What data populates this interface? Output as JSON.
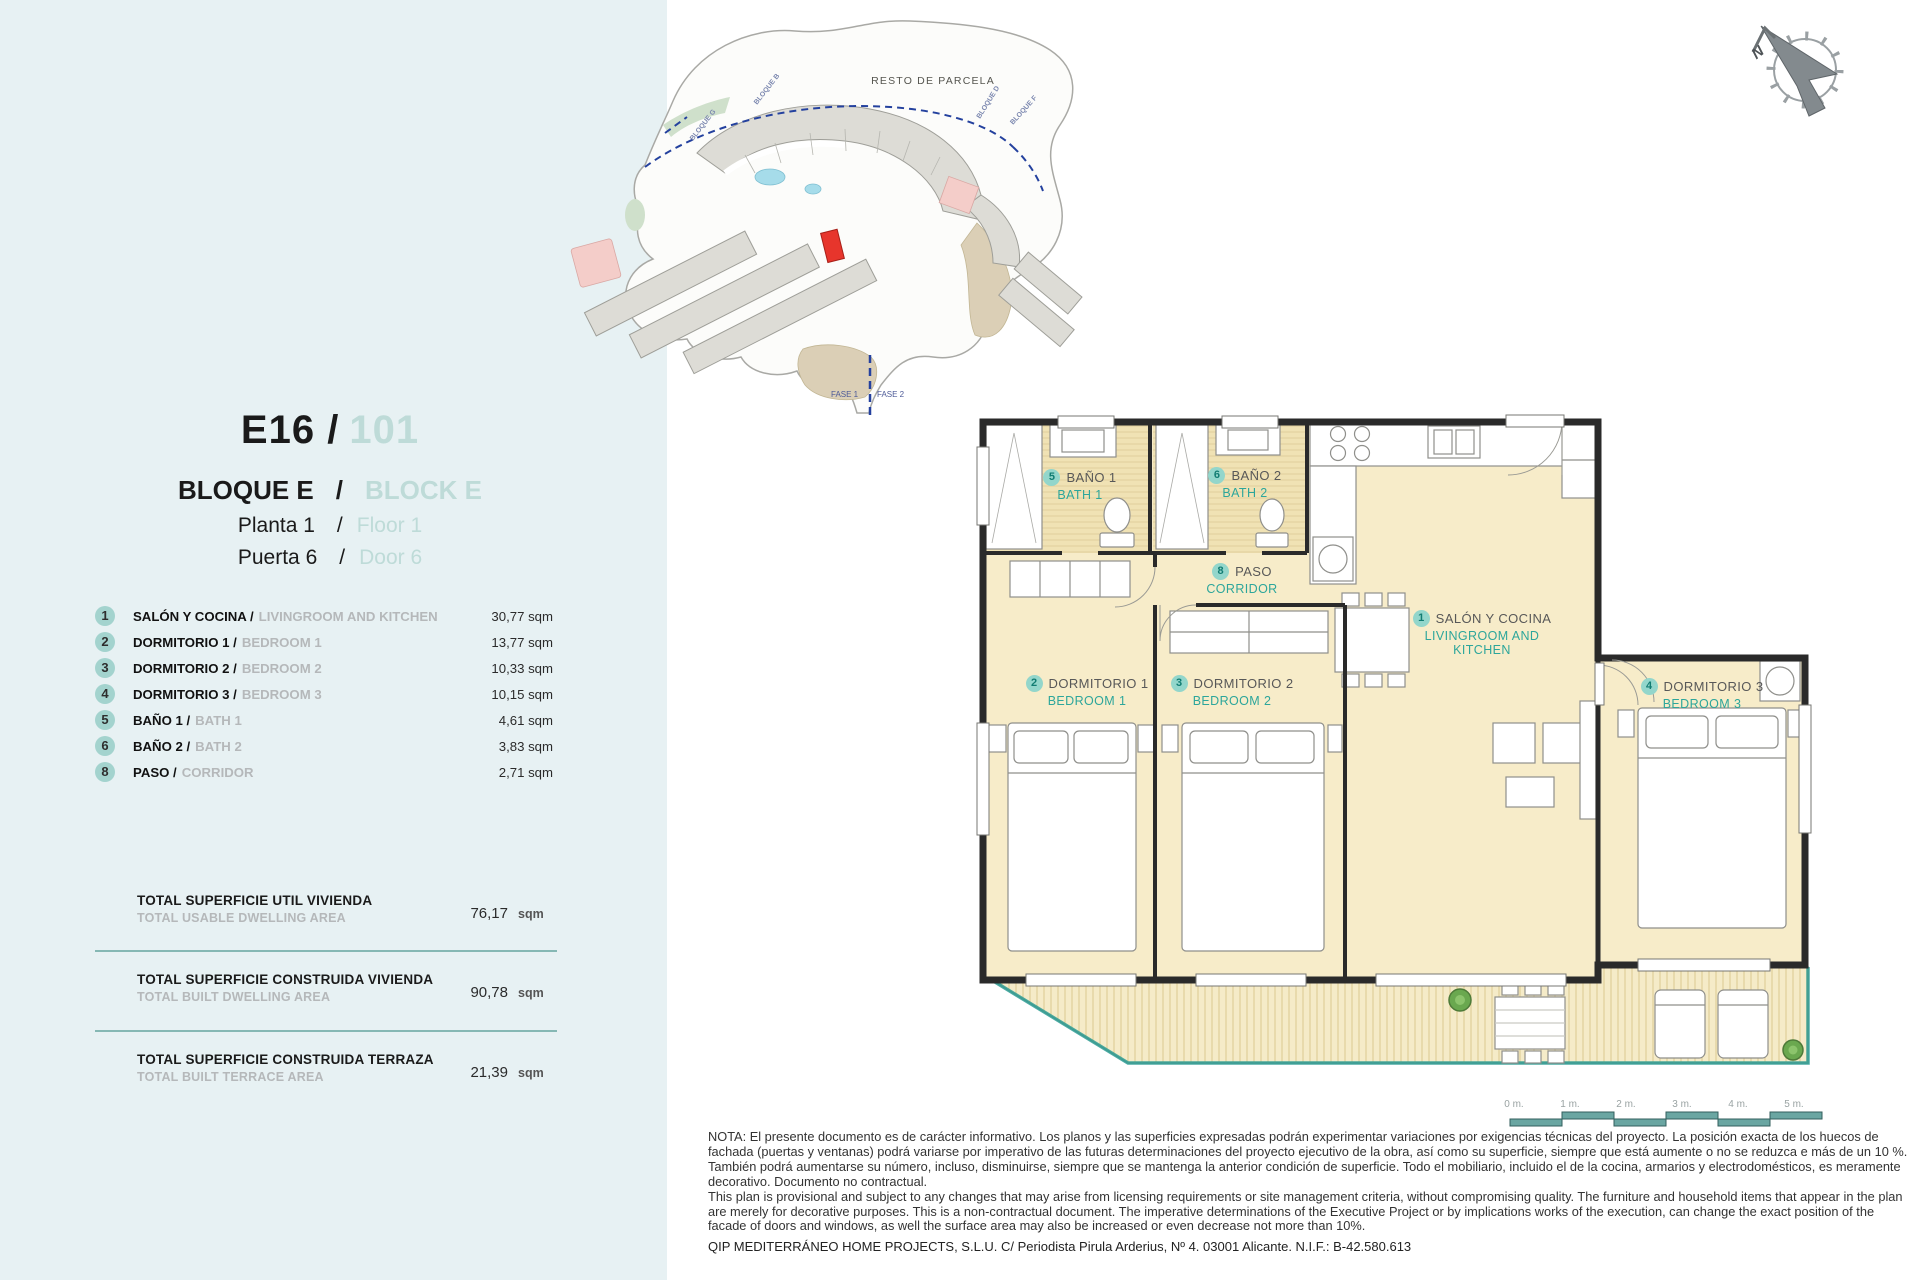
{
  "sidebar": {
    "unit": {
      "code": "E16 /",
      "number": "101"
    },
    "block": {
      "es": "BLOQUE E",
      "slash": "/",
      "en": "BLOCK E"
    },
    "floor": {
      "es": "Planta 1",
      "slash": "/",
      "en": "Floor 1"
    },
    "door": {
      "es": "Puerta 6",
      "slash": "/",
      "en": "Door 6"
    },
    "rooms": [
      {
        "num": "1",
        "es": "SALÓN Y COCINA /",
        "en": "LIVINGROOM AND KITCHEN",
        "area": "30,77 sqm"
      },
      {
        "num": "2",
        "es": "DORMITORIO 1 /",
        "en": "BEDROOM 1",
        "area": "13,77 sqm"
      },
      {
        "num": "3",
        "es": "DORMITORIO 2 /",
        "en": "BEDROOM 2",
        "area": "10,33 sqm"
      },
      {
        "num": "4",
        "es": "DORMITORIO 3 /",
        "en": "BEDROOM 3",
        "area": "10,15 sqm"
      },
      {
        "num": "5",
        "es": "BAÑO 1 /",
        "en": "BATH 1",
        "area": "4,61 sqm"
      },
      {
        "num": "6",
        "es": "BAÑO 2 /",
        "en": "BATH 2",
        "area": "3,83 sqm"
      },
      {
        "num": "8",
        "es": "PASO /",
        "en": "CORRIDOR",
        "area": "2,71 sqm"
      }
    ],
    "totals": [
      {
        "es": "TOTAL SUPERFICIE UTIL VIVIENDA",
        "en": "TOTAL USABLE DWELLING AREA",
        "value": "76,17",
        "unit": "sqm"
      },
      {
        "es": "TOTAL SUPERFICIE CONSTRUIDA VIVIENDA",
        "en": "TOTAL BUILT DWELLING AREA",
        "value": "90,78",
        "unit": "sqm"
      },
      {
        "es": "TOTAL SUPERFICIE CONSTRUIDA TERRAZA",
        "en": "TOTAL BUILT TERRACE AREA",
        "value": "21,39",
        "unit": "sqm"
      }
    ]
  },
  "site_plan": {
    "area_label": "RESTO DE PARCELA",
    "phase_1": "FASE 1",
    "phase_2": "FASE 2",
    "block_labels": [
      "BLOQUE G",
      "BLOQUE B",
      "BLOQUE D",
      "BLOQUE F"
    ],
    "marker_color": "#e7352c"
  },
  "floor_plan": {
    "rooms": [
      {
        "num": "1",
        "es": "SALÓN Y COCINA",
        "en": "LIVINGROOM AND KITCHEN"
      },
      {
        "num": "2",
        "es": "DORMITORIO 1",
        "en": "BEDROOM 1"
      },
      {
        "num": "3",
        "es": "DORMITORIO 2",
        "en": "BEDROOM 2"
      },
      {
        "num": "4",
        "es": "DORMITORIO 3",
        "en": "BEDROOM 3"
      },
      {
        "num": "5",
        "es": "BAÑO 1",
        "en": "BATH 1"
      },
      {
        "num": "6",
        "es": "BAÑO 2",
        "en": "BATH 2"
      },
      {
        "num": "8",
        "es": "PASO",
        "en": "CORRIDOR"
      }
    ],
    "accent_color": "#2da69b"
  },
  "compass": {
    "north": "N"
  },
  "scale_bar": {
    "labels": [
      "0 m.",
      "1 m.",
      "2 m.",
      "3 m.",
      "4 m.",
      "5 m."
    ]
  },
  "notes": {
    "es": "NOTA: El presente documento es de carácter informativo. Los planos y las superficies expresadas podrán experimentar variaciones por exigencias técnicas del proyecto. La posición exacta de los huecos de fachada (puertas y ventanas) podrá variarse por imperativo de las futuras determinaciones del proyecto ejecutivo de la obra, así como su superficie, siempre que está aumente o no se reduzca e más de un 10 %. También podrá aumentarse su número, incluso, disminuirse, siempre que se mantenga la anterior condición de superficie. Todo el mobiliario, incluido el de la cocina, armarios y electrodomésticos, es meramente decorativo. Documento no contractual.",
    "en": "This plan is provisional and subject to any changes that may arise from licensing requirements or site management criteria, without compromising quality. The furniture and household items that appear in the plan are merely for decorative purposes. This is a non-contractual document. The imperative determinations of the Executive Project or by implications works of the execution, can change the exact position of the facade of doors and windows, as well the surface area may also be increased or even decrease not more than 10%.",
    "company": "QIP MEDITERRÁNEO HOME PROJECTS, S.L.U. C/ Periodista Pirula Arderius, Nº 4. 03001 Alicante. N.I.F.: B-42.580.613"
  }
}
